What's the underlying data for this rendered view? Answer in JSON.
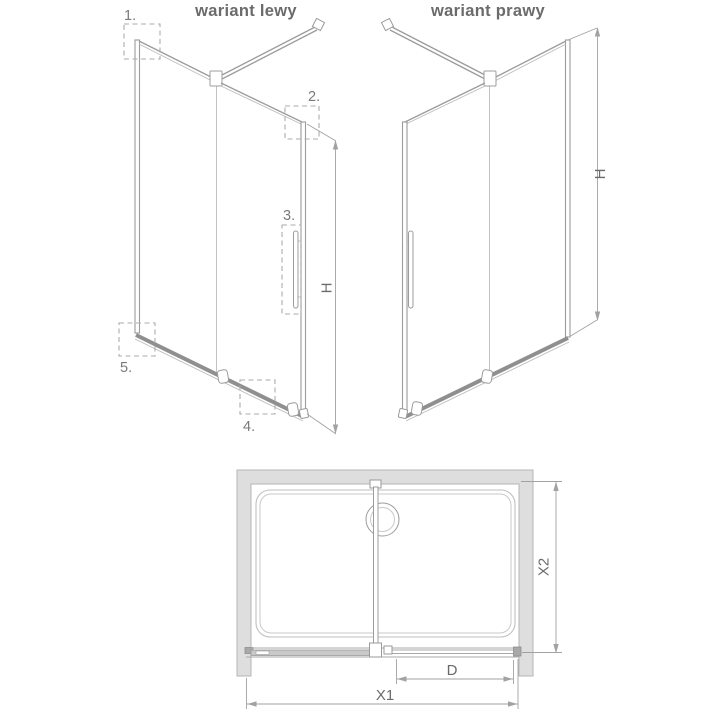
{
  "colors": {
    "line": "#9c9c9c",
    "rail": "#8f8f8f",
    "wall_fill": "#dedede",
    "wall_stroke": "#b5b5b5",
    "text": "#6b6b6b",
    "dashed_box": "#ababab"
  },
  "left_variant": {
    "title": "wariant lewy",
    "height_label": "H",
    "callouts": [
      {
        "label": "1."
      },
      {
        "label": "2."
      },
      {
        "label": "3."
      },
      {
        "label": "4."
      },
      {
        "label": "5."
      }
    ]
  },
  "right_variant": {
    "title": "wariant prawy",
    "height_label": "H"
  },
  "plan_view": {
    "labels": {
      "total_width": "X1",
      "depth": "X2",
      "door_width": "D"
    }
  }
}
